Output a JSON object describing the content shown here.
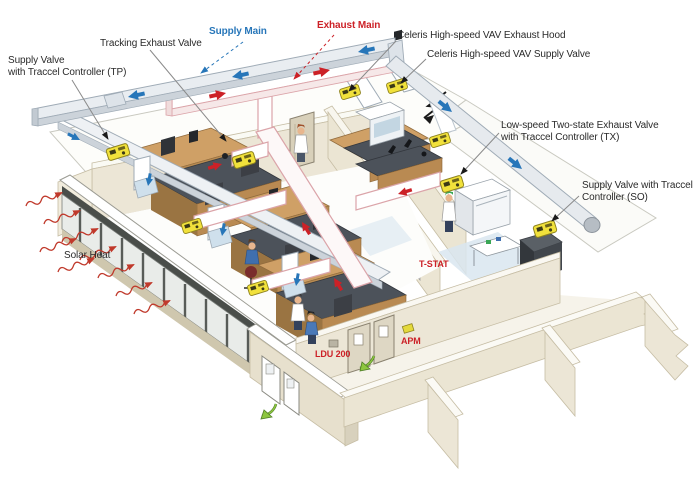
{
  "diagram": {
    "title": "Laboratory airflow control system isometric diagram",
    "labels": {
      "supply_valve_tp": {
        "line1": "Supply Valve",
        "line2": "with Traccel Controller (TP)"
      },
      "tracking_exhaust_valve": {
        "text": "Tracking Exhaust Valve"
      },
      "supply_main": {
        "text": "Supply Main"
      },
      "exhaust_main": {
        "text": "Exhaust Main"
      },
      "celeris_exhaust_hood": {
        "text": "Celeris High-speed VAV Exhaust Hood"
      },
      "celeris_supply_valve": {
        "text": "Celeris High-speed VAV Supply Valve"
      },
      "low_speed_tx": {
        "line1": "Low-speed Two-state Exhaust Valve",
        "line2": "with Traccel Controller (TX)"
      },
      "supply_valve_so": {
        "line1": "Supply Valve with Traccel",
        "line2": "Controller (SO)"
      },
      "solar_heat": {
        "text": "Solar Heat"
      },
      "t_stat": {
        "text": "T-STAT"
      },
      "ldu_200": {
        "text": "LDU 200"
      },
      "apm": {
        "text": "APM"
      }
    },
    "colors": {
      "supply_blue": "#2776b9",
      "exhaust_red": "#cc2127",
      "valve_yellow": "#f1e13b",
      "wall_cream": "#ece6d6",
      "wood": "#c9995f",
      "counter_dark": "#4c525a",
      "green_arrow": "#7db940",
      "duct_gray": "#e9edf1",
      "exhaust_duct_outline": "#dba4a9"
    }
  }
}
